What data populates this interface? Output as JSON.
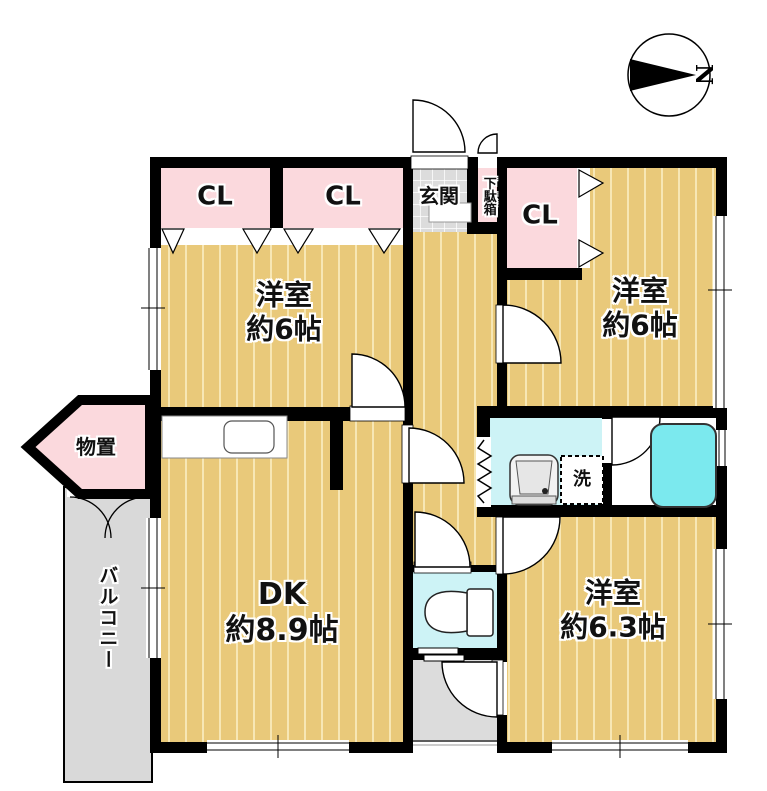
{
  "compass": {
    "label": "N"
  },
  "rooms": {
    "closet_nw_left": {
      "label": "CL"
    },
    "closet_nw_right": {
      "label": "CL"
    },
    "closet_ne": {
      "label": "CL"
    },
    "entrance": {
      "label": "玄関"
    },
    "shoe_cabinet": {
      "label": "下駄箱"
    },
    "bedroom_nw": {
      "name": "洋室",
      "size": "約6帖"
    },
    "bedroom_ne": {
      "name": "洋室",
      "size": "約6帖"
    },
    "dining_kitchen": {
      "name": "DK",
      "size": "約8.9帖"
    },
    "bedroom_se": {
      "name": "洋室",
      "size": "約6.3帖"
    },
    "storage": {
      "label": "物置"
    },
    "balcony": {
      "label": "バルコニー"
    },
    "laundry": {
      "label": "洗"
    }
  },
  "colors": {
    "wall": "#000000",
    "wood_floor": "#e9c97a",
    "wood_stripe": "#f7e7b5",
    "closet_pink": "#fbd9dd",
    "wet_area_cyan": "#cdf3f6",
    "bathtub_cyan": "#7be9ee",
    "balcony_gray": "#d9d9d9",
    "entrance_tile_gray": "#dcdcdc"
  }
}
